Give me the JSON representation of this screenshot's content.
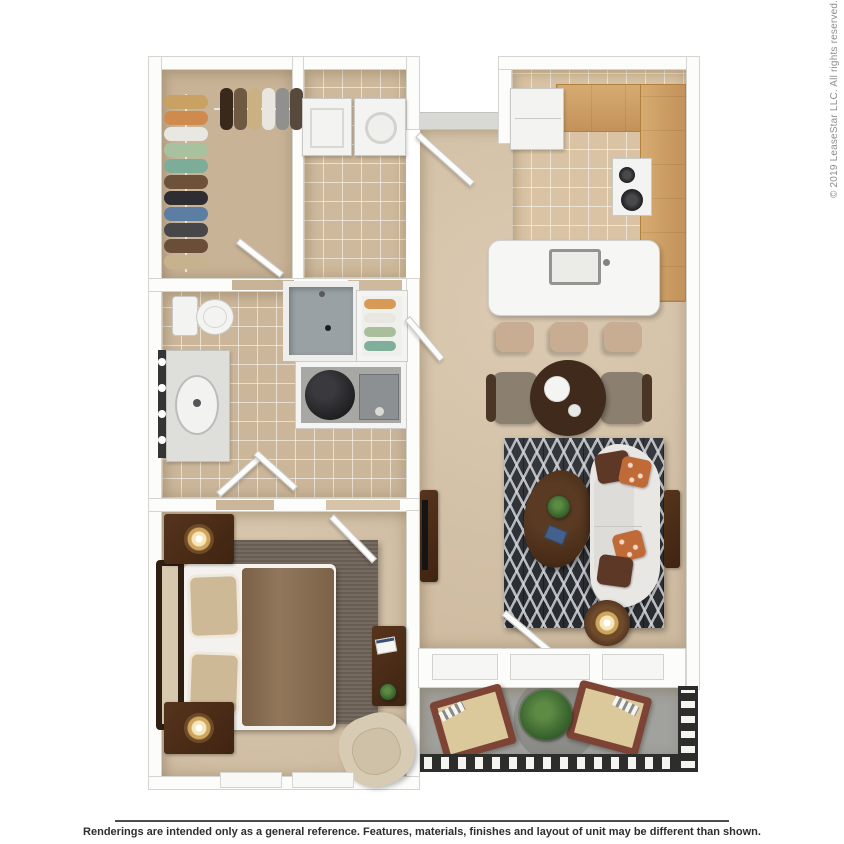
{
  "page": {
    "copyright": "© 2019 LeaseStar LLC. All rights reserved.",
    "disclaimer": "Renderings are intended only as a general reference. Features, materials, finishes and layout of unit may be different than shown."
  },
  "floorplan": {
    "view": "3d-top-down-rendering",
    "colors": {
      "background": "#ffffff",
      "walls": "#fcfcfb",
      "carpet_floor": "#d7c4a9",
      "tile_floor": "#cdb79b",
      "kitchen_counter_wood": "#cda268",
      "living_rug": "#303338",
      "bedroom_rug": "#6e6357",
      "sofa": "#e9e7e4",
      "accent_pillow_orange": "#c06a38",
      "accent_pillow_brown": "#5e3826",
      "dark_wood_furniture": "#46290f",
      "balcony_concrete": "#a1a19d",
      "railing": "#2d2d2b"
    }
  }
}
